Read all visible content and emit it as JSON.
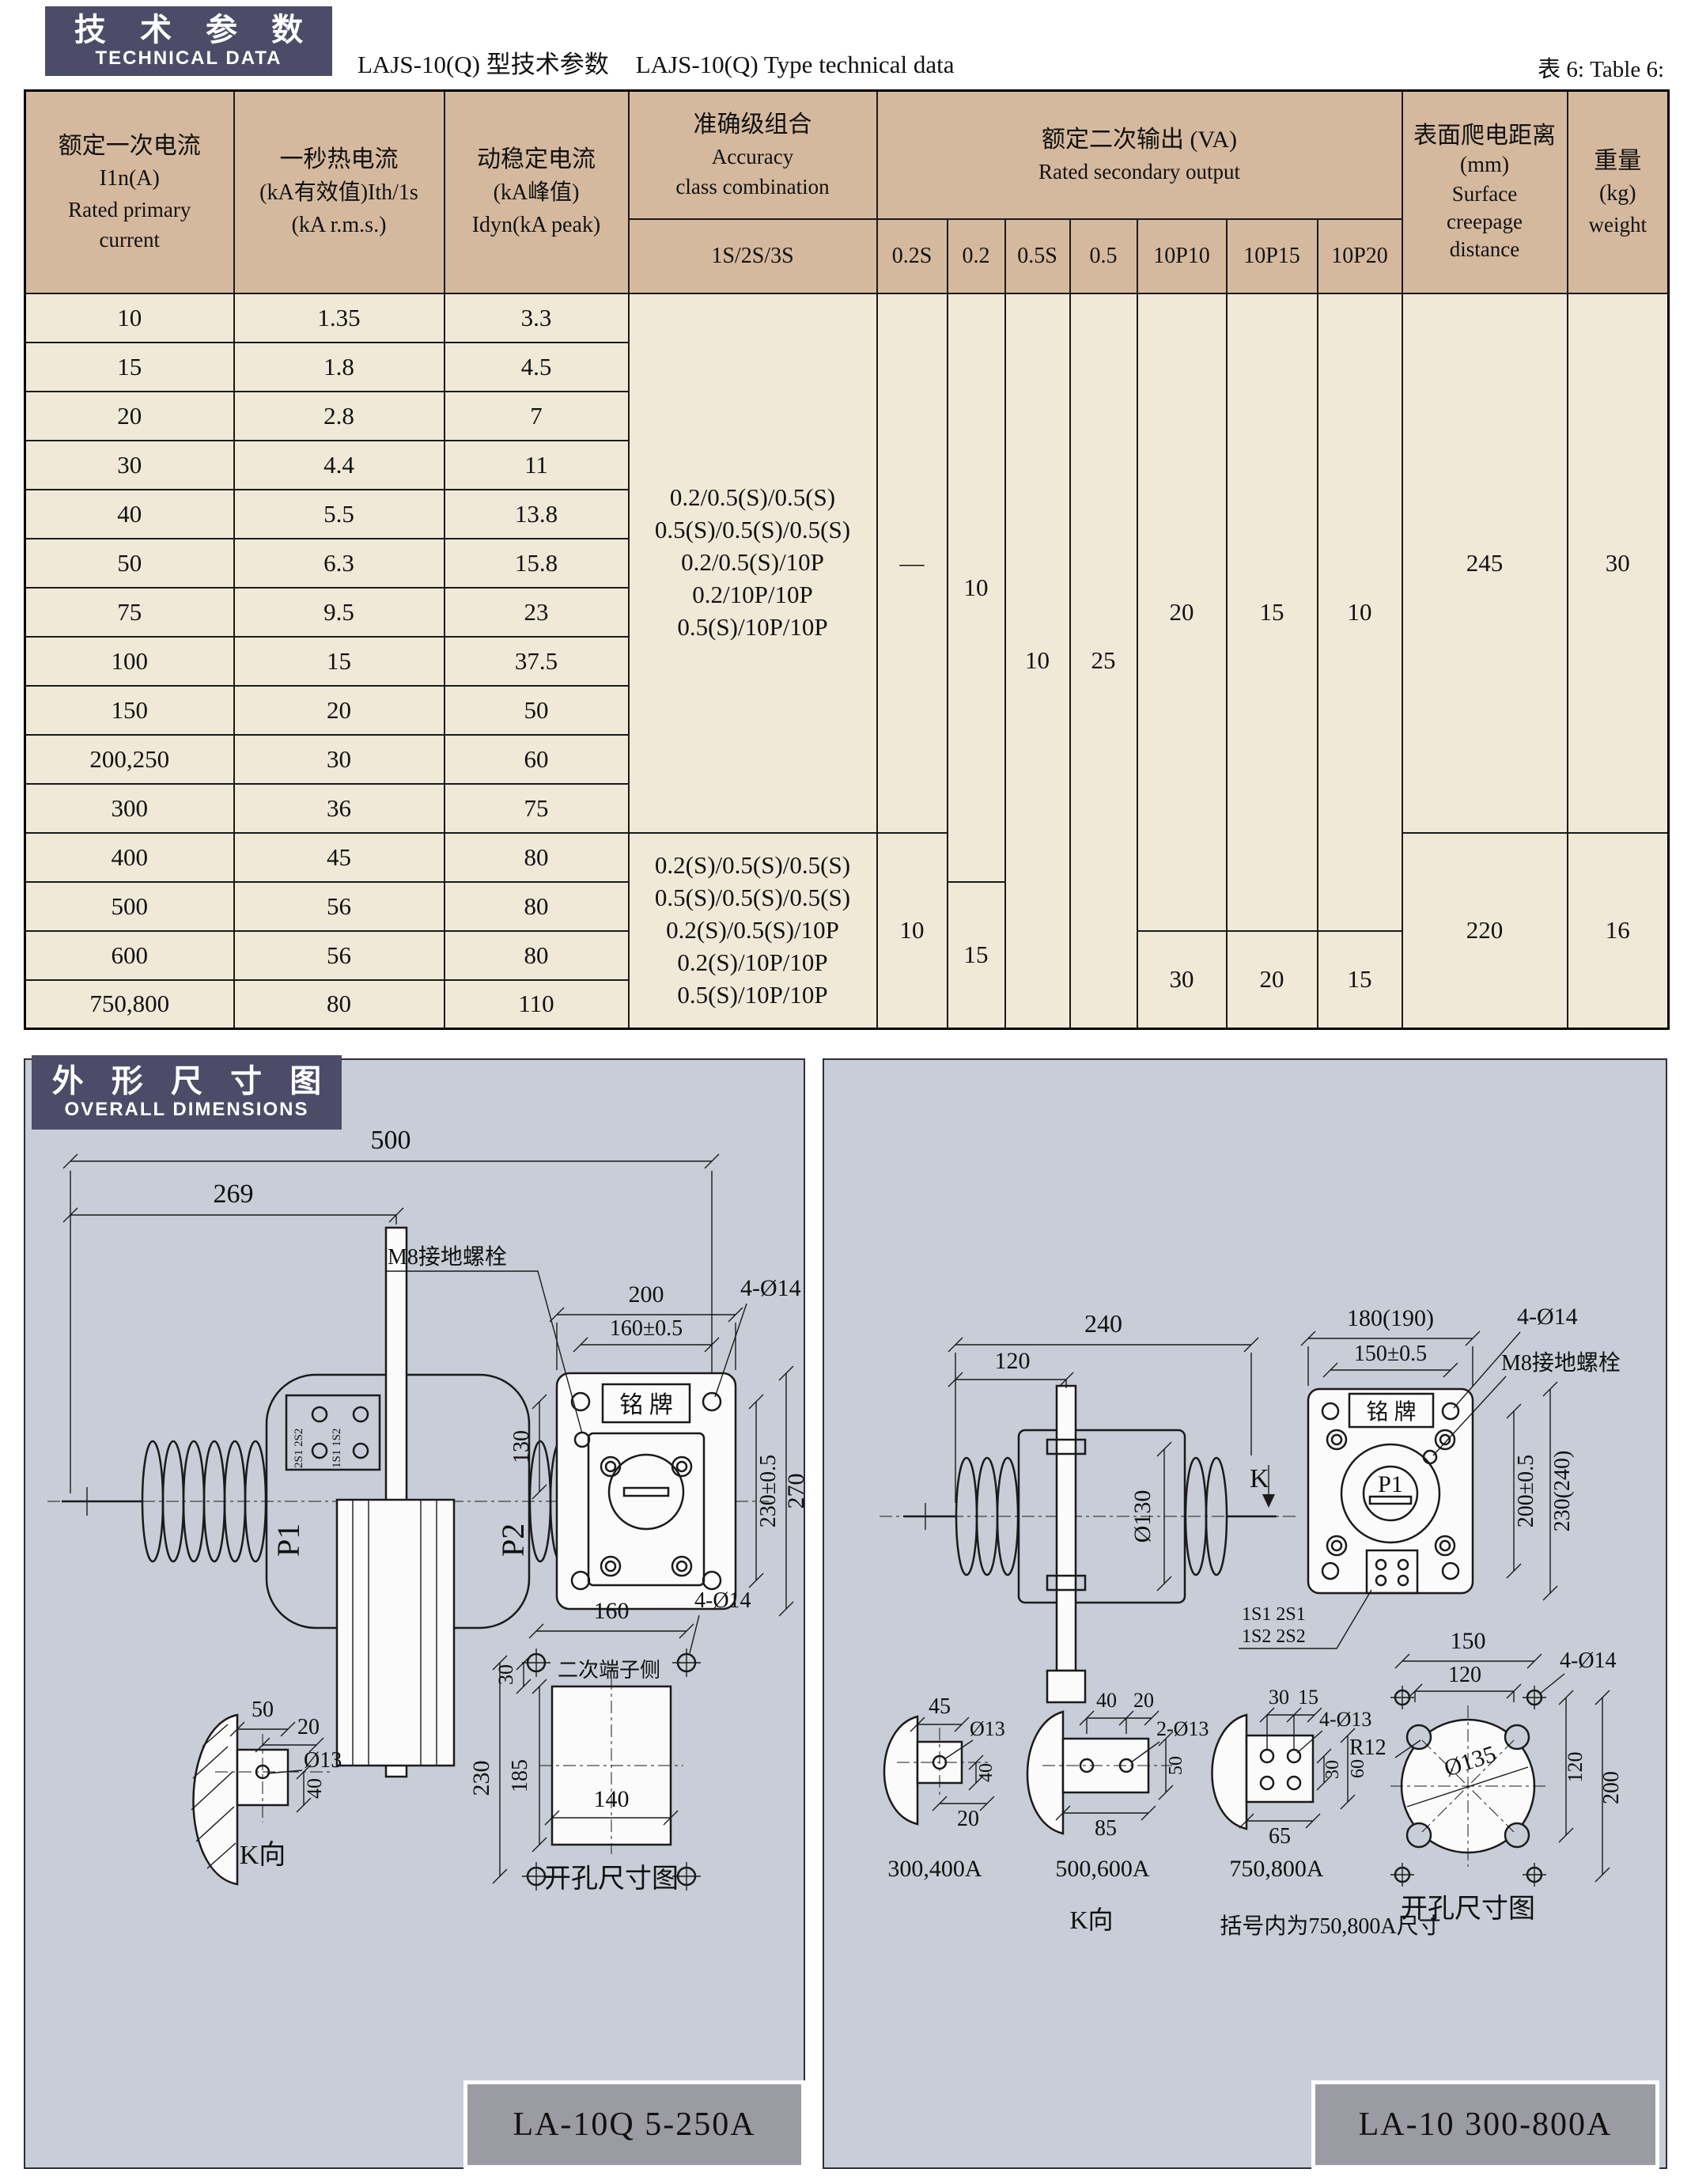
{
  "header": {
    "tech_cn": "技 术 参 数",
    "tech_en": "TECHNICAL DATA",
    "title_cn": "LAJS-10(Q) 型技术参数",
    "title_en": "LAJS-10(Q) Type technical data",
    "table_tag": "表 6: Table 6:"
  },
  "dims_header": {
    "cn": "外 形 尺 寸 图",
    "en": "OVERALL DIMENSIONS"
  },
  "colors": {
    "dark_header_bg": "#4d4c68",
    "table_header_bg": "#d5b99e",
    "table_body_bg": "#f0e9d7",
    "panel_bg": "#c8cdd7",
    "caption_bg": "#9b9ba3"
  },
  "table": {
    "head": {
      "primary_cn": "额定一次电流",
      "primary_sym": "I1n(A)",
      "primary_en1": "Rated primary",
      "primary_en2": "current",
      "thermal_cn": "一秒热电流",
      "thermal_sym": "(kA有效值)Ith/1s",
      "thermal_en": "(kA r.m.s.)",
      "dynamic_cn": "动稳定电流",
      "dynamic_sym": "(kA峰值)",
      "dynamic_en": "Idyn(kA peak)",
      "accuracy_cn": "准确级组合",
      "accuracy_en1": "Accuracy",
      "accuracy_en2": "class combination",
      "accuracy_sub": "1S/2S/3S",
      "va_cn": "额定二次输出 (VA)",
      "va_en": "Rated secondary output",
      "va_cols": [
        "0.2S",
        "0.2",
        "0.5S",
        "0.5",
        "10P10",
        "10P15",
        "10P20"
      ],
      "creepage_cn": "表面爬电距离",
      "creepage_unit": "(mm)",
      "creepage_en1": "Surface",
      "creepage_en2": "creepage",
      "creepage_en3": "distance",
      "weight_cn": "重量",
      "weight_unit": "(kg)",
      "weight_en": "weight"
    },
    "rows": [
      {
        "c": "10",
        "t": "1.35",
        "d": "3.3"
      },
      {
        "c": "15",
        "t": "1.8",
        "d": "4.5"
      },
      {
        "c": "20",
        "t": "2.8",
        "d": "7"
      },
      {
        "c": "30",
        "t": "4.4",
        "d": "11"
      },
      {
        "c": "40",
        "t": "5.5",
        "d": "13.8"
      },
      {
        "c": "50",
        "t": "6.3",
        "d": "15.8"
      },
      {
        "c": "75",
        "t": "9.5",
        "d": "23"
      },
      {
        "c": "100",
        "t": "15",
        "d": "37.5"
      },
      {
        "c": "150",
        "t": "20",
        "d": "50"
      },
      {
        "c": "200,250",
        "t": "30",
        "d": "60"
      },
      {
        "c": "300",
        "t": "36",
        "d": "75"
      },
      {
        "c": "400",
        "t": "45",
        "d": "80"
      },
      {
        "c": "500",
        "t": "56",
        "d": "80"
      },
      {
        "c": "600",
        "t": "56",
        "d": "80"
      },
      {
        "c": "750,800",
        "t": "80",
        "d": "110"
      }
    ],
    "accuracy_block1": [
      "0.2/0.5(S)/0.5(S)",
      "0.5(S)/0.5(S)/0.5(S)",
      "0.2/0.5(S)/10P",
      "0.2/10P/10P",
      "0.5(S)/10P/10P"
    ],
    "accuracy_block2": [
      "0.2(S)/0.5(S)/0.5(S)",
      "0.5(S)/0.5(S)/0.5(S)",
      "0.2(S)/0.5(S)/10P",
      "0.2(S)/10P/10P",
      "0.5(S)/10P/10P"
    ],
    "va": {
      "s02S_a": "—",
      "s02S_b": "10",
      "s02_a": "10",
      "s02_b": "15",
      "s05S": "10",
      "s05": "25",
      "p10_a": "20",
      "p10_b": "30",
      "p15_a": "15",
      "p15_b": "20",
      "p20_a": "10",
      "p20_b": "15"
    },
    "creepage_a": "245",
    "creepage_b": "220",
    "weight_a": "30",
    "weight_b": "16"
  },
  "drawings": {
    "left": {
      "caption": "LA-10Q  5-250A",
      "side": {
        "dim_500": "500",
        "dim_269": "269",
        "p1": "P1",
        "p2": "P2",
        "k": "K",
        "t_a": "2S1 2S2",
        "t_b": "1S1 1S2"
      },
      "front": {
        "dim_200": "200",
        "dim_160": "160±0.5",
        "holes": "4-Ø14",
        "m8": "M8接地螺栓",
        "nameplate": "铭 牌",
        "dim_130": "130",
        "dim_230": "230±0.5",
        "dim_270": "270"
      },
      "kview": {
        "dim_50": "50",
        "dim_20": "20",
        "hole": "Ø13",
        "dim_40": "40",
        "caption": "K向"
      },
      "opening": {
        "dim_160": "160",
        "holes": "4-Ø14",
        "side_note": "二次端子侧",
        "dim_30": "30",
        "dim_185": "185",
        "dim_230": "230",
        "dim_140": "140",
        "caption": "开孔尺寸图"
      }
    },
    "right": {
      "caption": "LA-10  300-800A",
      "side": {
        "dim_240": "240",
        "dim_120": "120",
        "dia": "Ø130",
        "k": "K"
      },
      "front": {
        "dim_180": "180(190)",
        "dim_150": "150±0.5",
        "holes": "4-Ø14",
        "m8": "M8接地螺栓",
        "nameplate": "铭 牌",
        "p1": "P1",
        "dim_200": "200±0.5",
        "dim_230": "230(240)",
        "t_a": "1S1 2S1",
        "t_b": "1S2 2S2"
      },
      "mount_a": {
        "dim_45": "45",
        "hole": "Ø13",
        "dim_40": "40",
        "dim_20": "20",
        "caption": "300,400A"
      },
      "mount_b": {
        "dim_40": "40",
        "dim_20": "20",
        "hole": "2-Ø13",
        "dim_50": "50",
        "dim_85": "85",
        "caption": "500,600A"
      },
      "mount_c": {
        "dim_30": "30",
        "dim_15": "15",
        "hole": "4-Ø13",
        "dim_30b": "30",
        "dim_60": "60",
        "dim_65": "65",
        "caption": "750,800A"
      },
      "kview_caption": "K向",
      "note": "括号内为750,800A尺寸",
      "opening": {
        "dim_150": "150",
        "dim_120_top": "120",
        "holes": "4-Ø14",
        "r": "R12",
        "dia": "Ø135",
        "dim_120_right": "120",
        "dim_200": "200",
        "caption": "开孔尺寸图"
      }
    }
  }
}
